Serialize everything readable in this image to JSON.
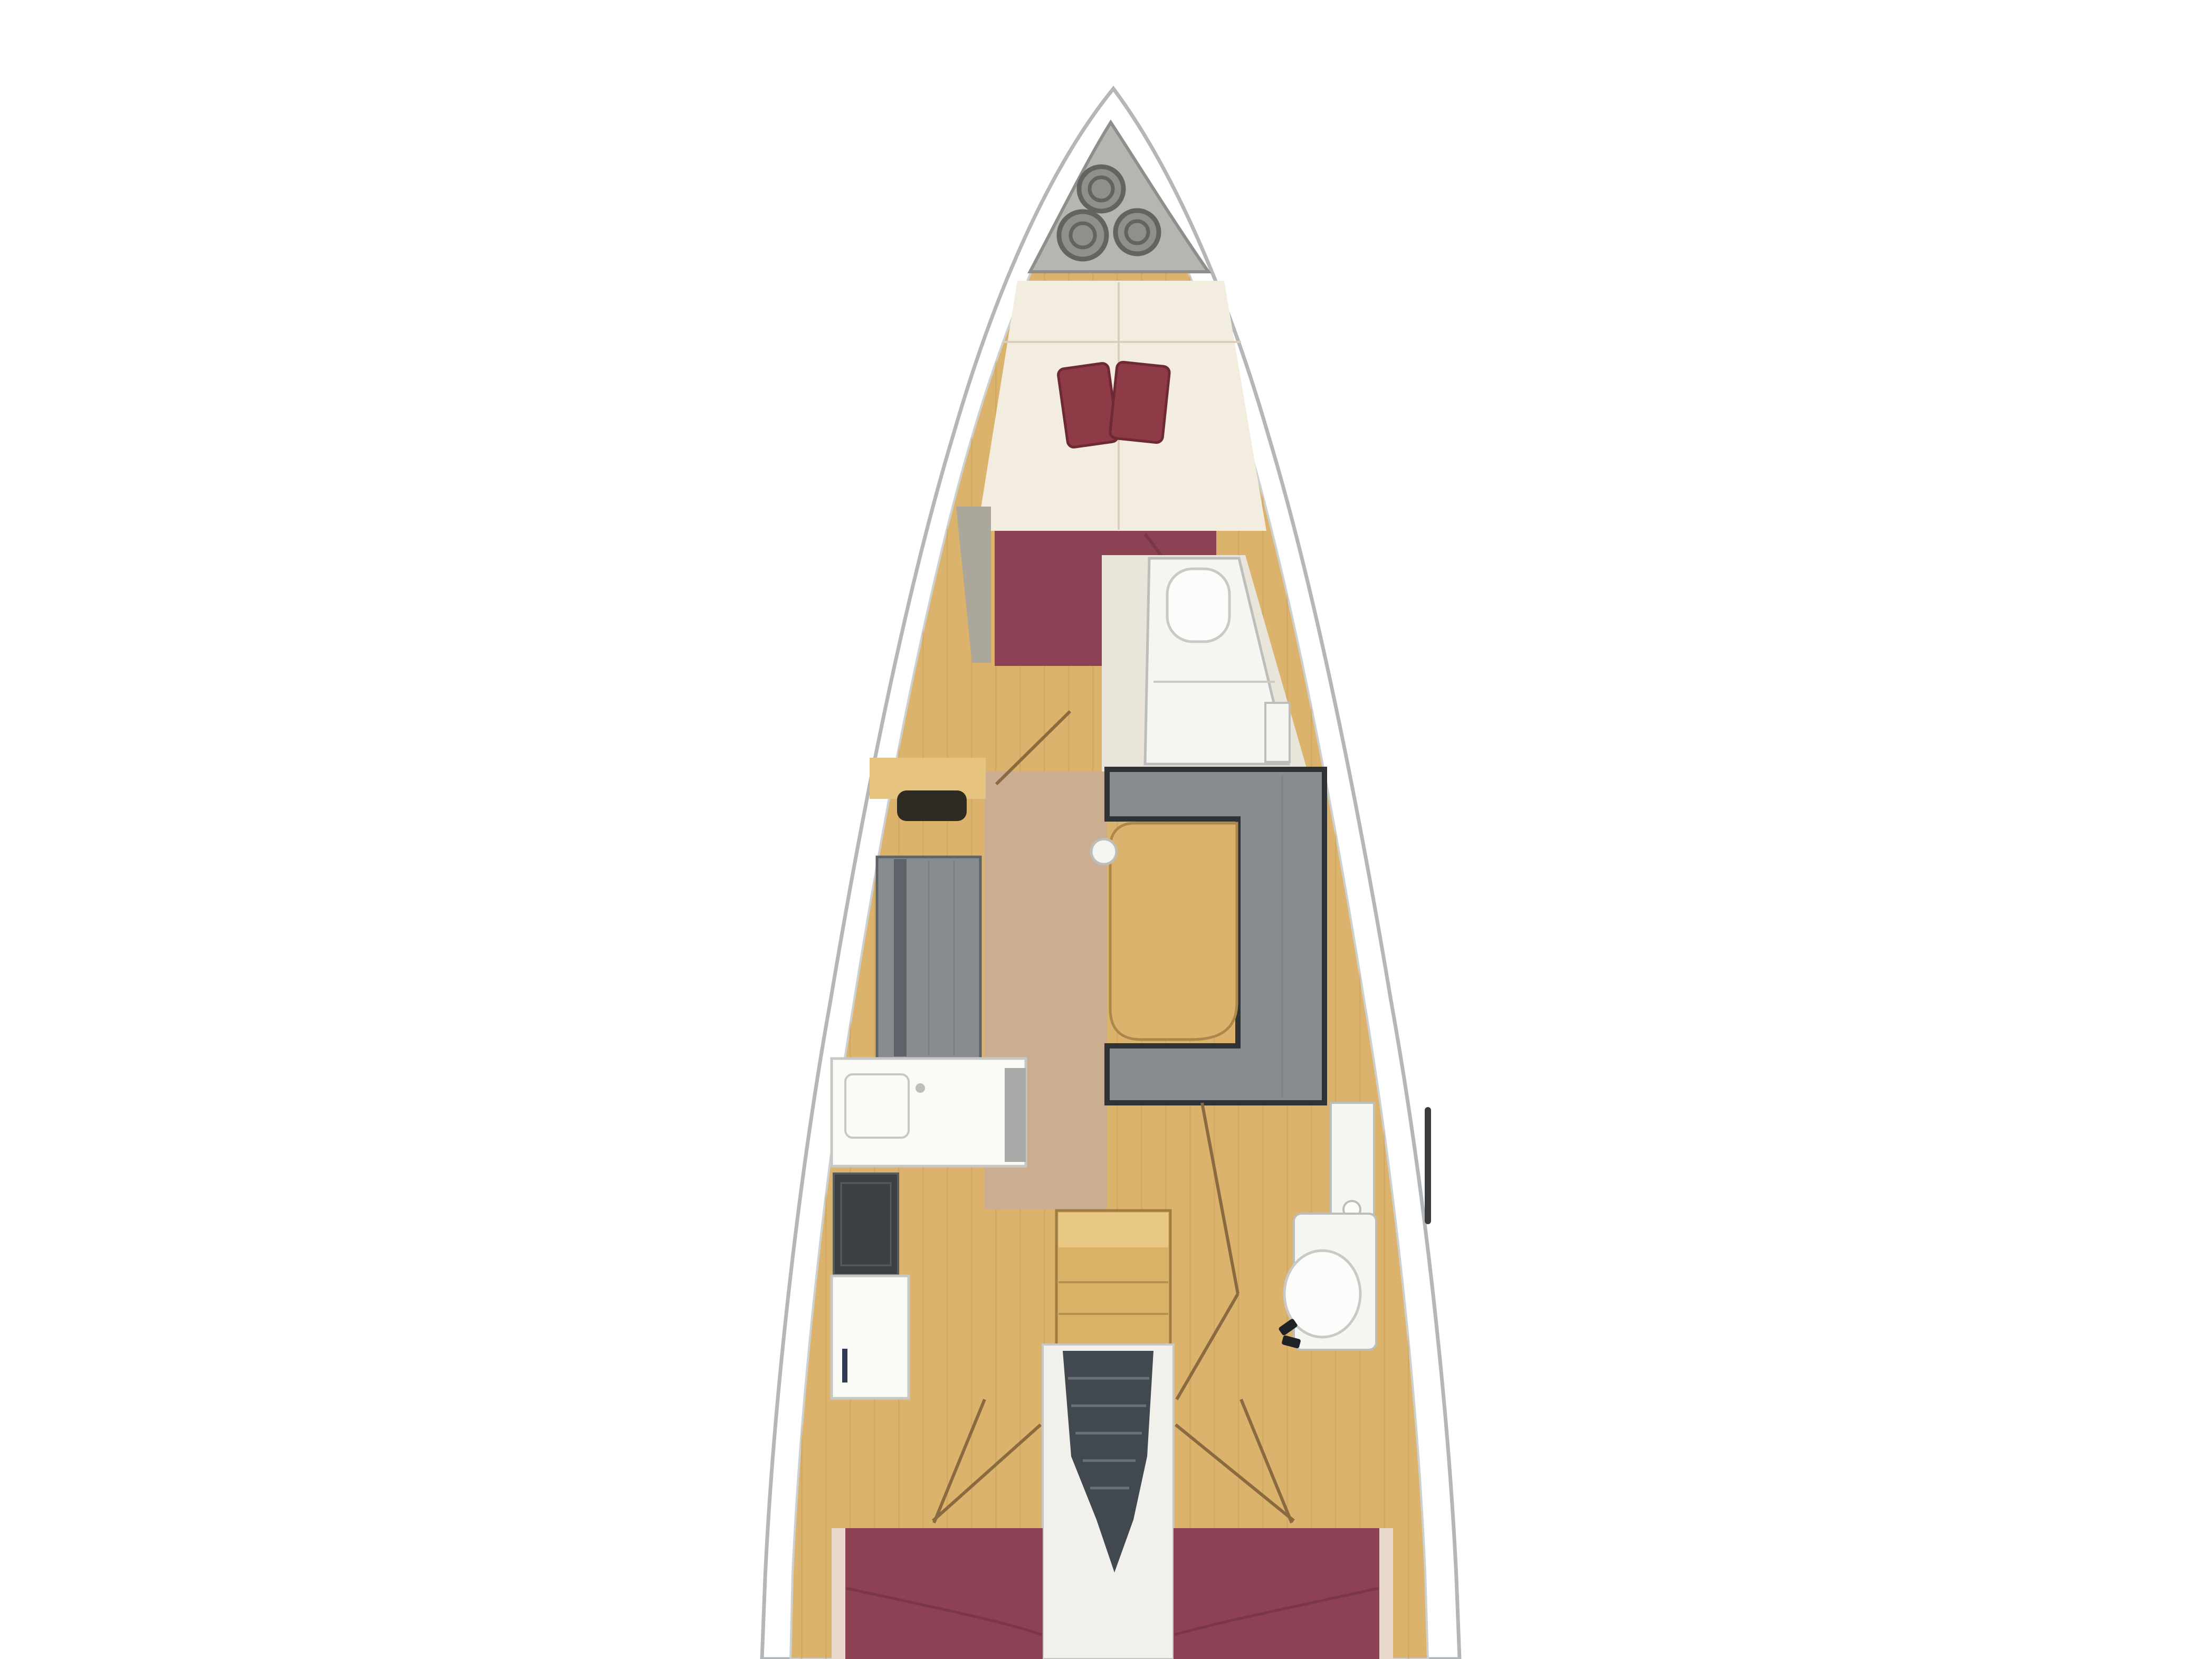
{
  "figure": {
    "kind": "sailing-yacht-interior-floor-plan",
    "orientation": "bow-up"
  },
  "palette": {
    "background": "#ffffff",
    "hull_band": "#ffffff",
    "hull_outline": "#b3b7b9",
    "hull_inner_line": "#cdd0d1",
    "deck_wood": "#dcb36c",
    "plank_line": "#c69c56",
    "walkway_floor": "#cbae92",
    "anchor_locker": "#b5b5b2",
    "anchor_locker_edge": "#8e8e8b",
    "rope_coil": "#8f8f8c",
    "rope_coil_ring": "#636360",
    "vberth_cream": "#f2edde",
    "vberth_seam": "#d9d0bb",
    "pillow": "#8e3b46",
    "pillow_edge": "#6e2a34",
    "bed_burgundy": "#8c4154",
    "bed_fold": "#7a3746",
    "bed_trim": "#e9dacd",
    "locker_wedge": "#aca79b",
    "head_floor": "#e9e5da",
    "fixture_white": "#f5f5f2",
    "fixture_outline": "#bdbdb9",
    "toilet_white": "#fcfcfa",
    "toilet_outline": "#c9c9c5",
    "hinge_dark": "#1f2326",
    "settee_gray": "#878c91",
    "settee_rib": "#73787d",
    "settee_dark": "#2f3337",
    "settee_back": "#5d6368",
    "shelf_wood": "#e6c47f",
    "shelf_slot": "#2e2b23",
    "counter_white": "#fafaf7",
    "counter_outline": "#c7c7c3",
    "counter_side": "#a9aaa8",
    "stove_dark": "#3b4043",
    "stove_line": "#565b5e",
    "handle_dark": "#2f3b52",
    "seat_wood_light": "#e8c783",
    "seat_wood": "#d9b268",
    "seat_outline": "#a07c41",
    "table_wood": "#dcb36c",
    "table_outline": "#ad8749",
    "companionway_white": "#f1f0eb",
    "steps_dark": "#41484f",
    "steps_line": "#697077",
    "door_line": "#8a6a3f",
    "window_dark": "#3a3d3f"
  }
}
